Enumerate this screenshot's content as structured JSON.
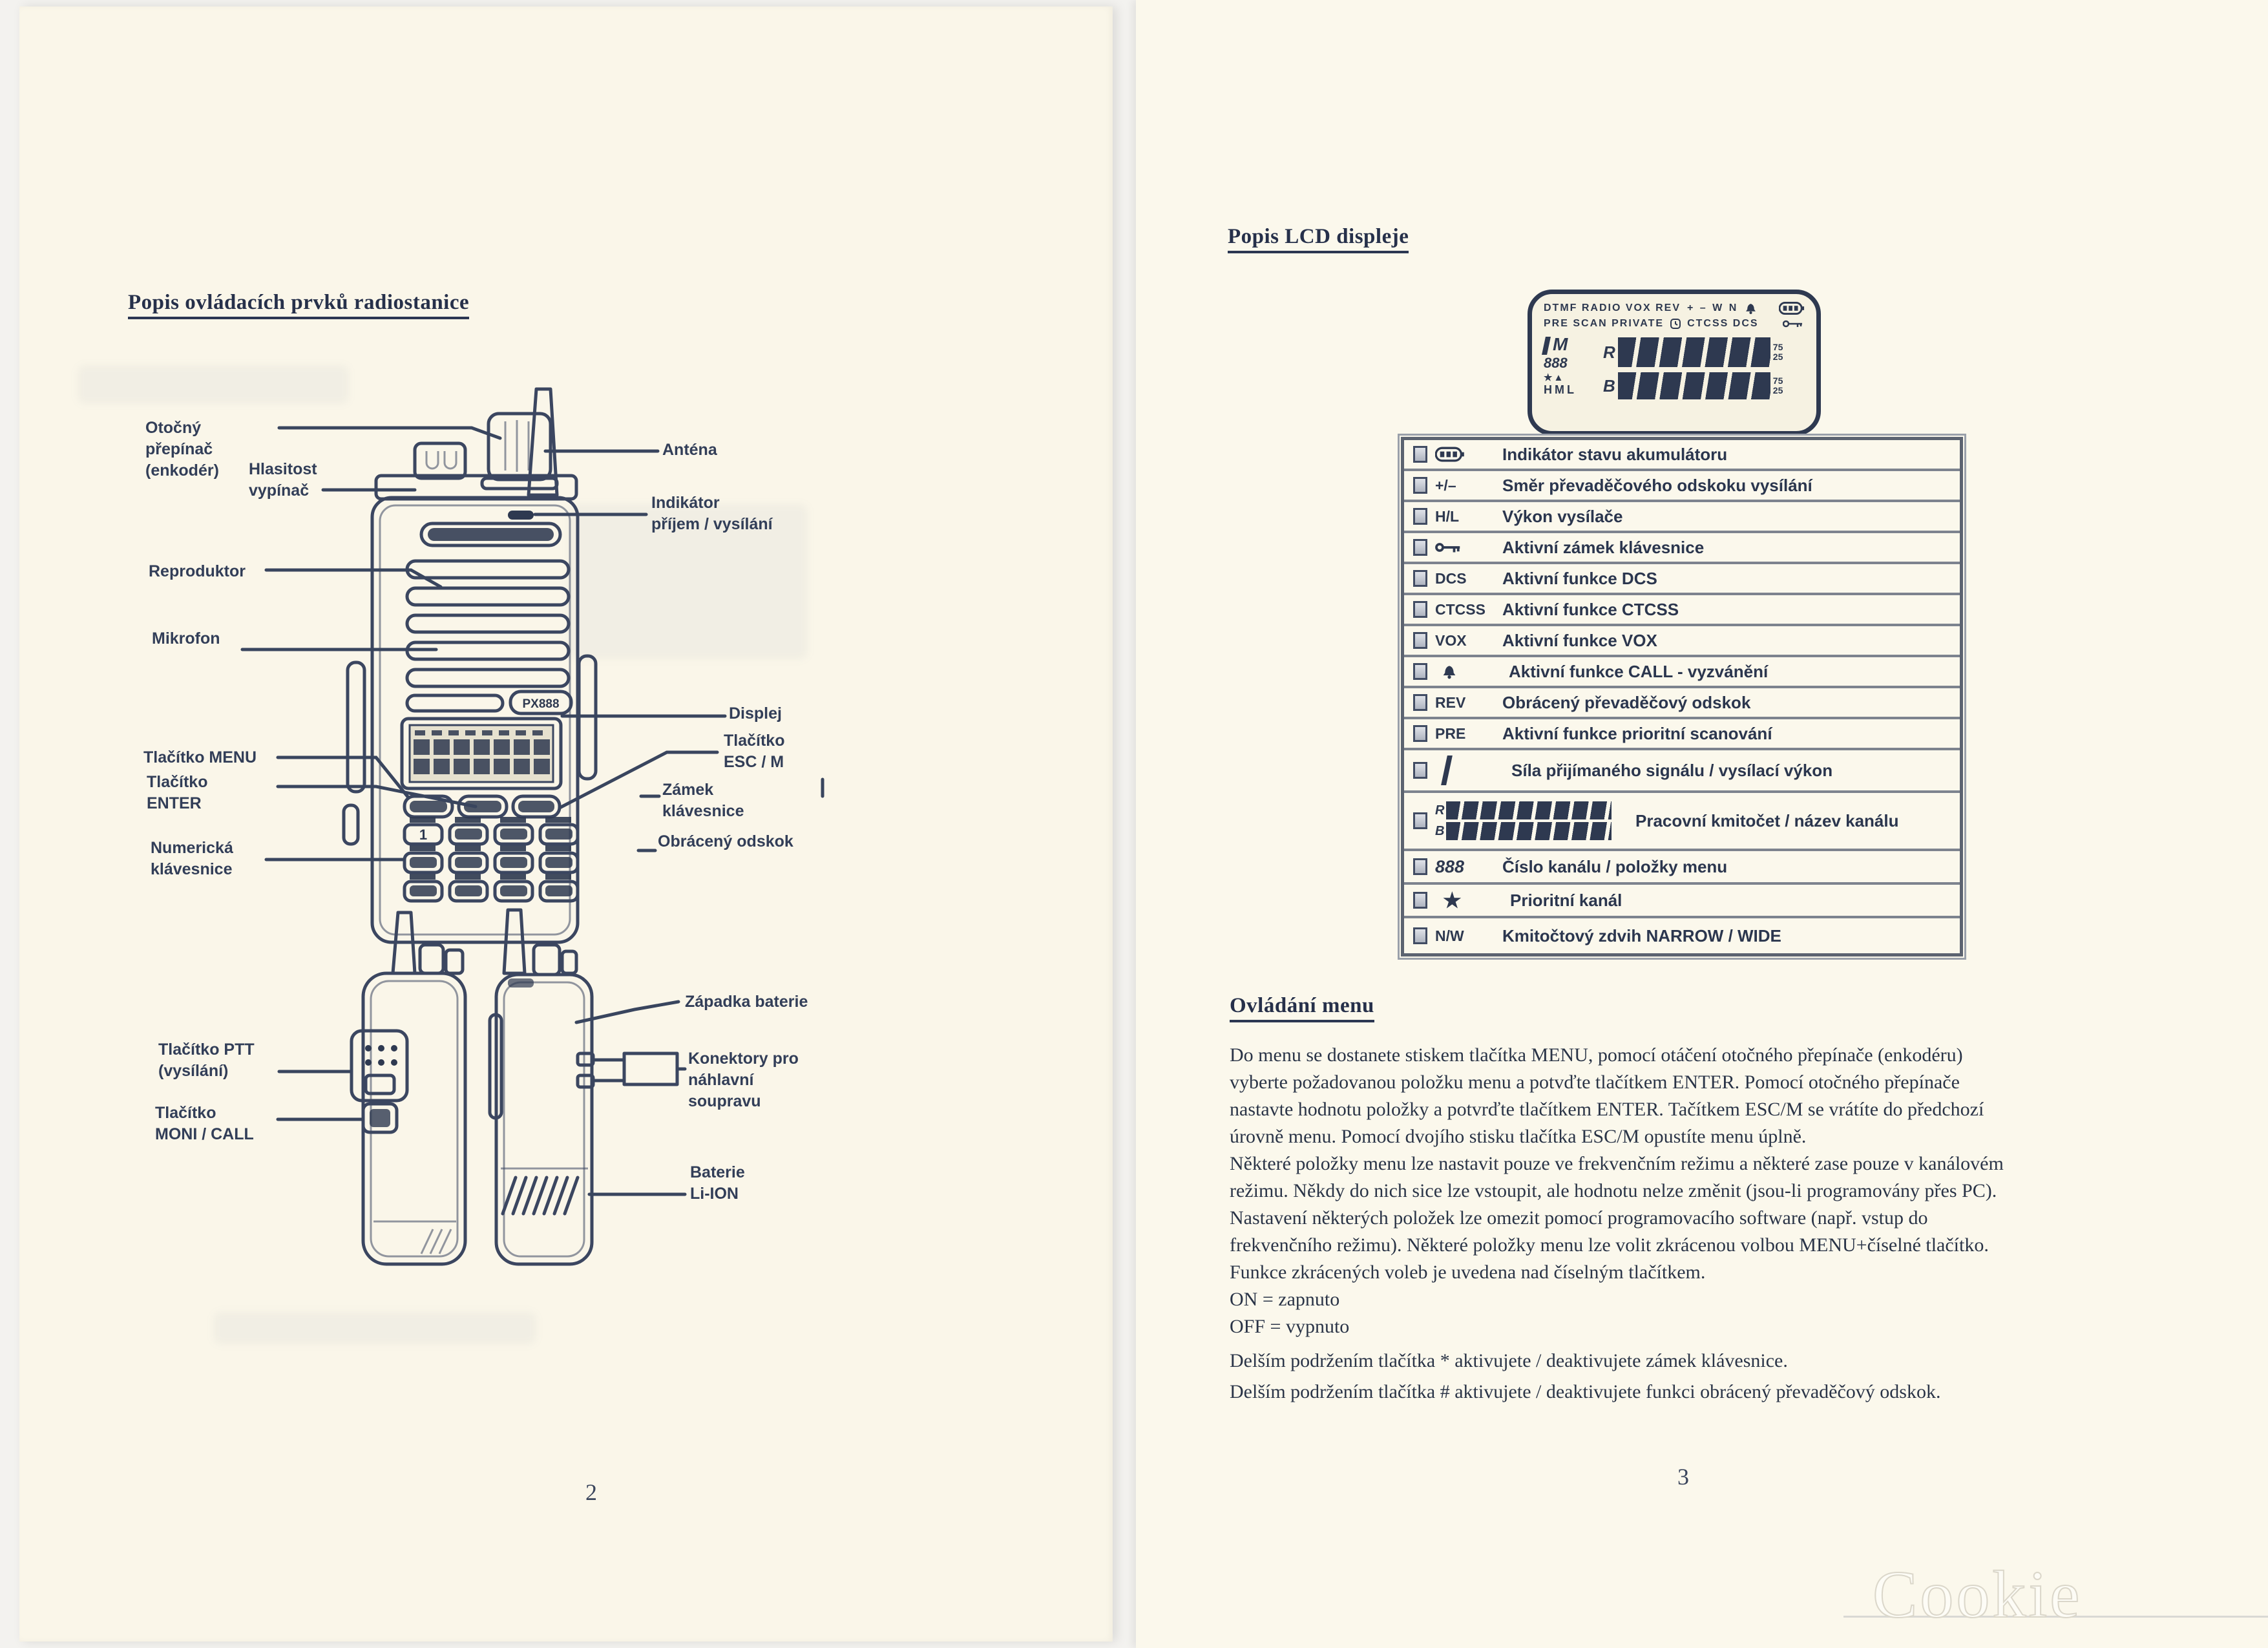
{
  "left_page": {
    "title": "Popis ovládacích prvků radiostanice",
    "page_number": "2",
    "radio": {
      "model": "PX888",
      "key1": "1"
    },
    "front_labels": {
      "rotary": "Otočný\npřepínač\n(enkodér)",
      "volume": "Hlasitost\nvypínač",
      "speaker": "Reproduktor",
      "mic": "Mikrofon",
      "menu": "Tlačítko MENU",
      "enter": "Tlačítko\nENTER",
      "numkeys": "Numerická\nklávesnice",
      "antenna": "Anténa",
      "indicator": "Indikátor\npříjem / vysílání",
      "display": "Displej",
      "esc": "Tlačítko\nESC / M",
      "keylock": "Zámek\nklávesnice",
      "reverse": "Obrácený odskok"
    },
    "side_labels": {
      "ptt": "Tlačítko PTT\n(vysílání)",
      "moni": "Tlačítko\nMONI / CALL",
      "latch": "Západka baterie",
      "connectors": "Konektory pro\nnáhlavní\nsoupravu",
      "battery": "Baterie\nLi-ION"
    }
  },
  "right_page": {
    "title": "Popis LCD displeje",
    "page_number": "3",
    "lcd": {
      "row1_left": "DTMF RADIO VOX REV",
      "row1_right": "+ – W N",
      "row2_left": "PRE SCAN PRIVATE",
      "row2_right": "CTCSS DCS",
      "big_m": "M",
      "digits": "888",
      "stars": "★▲",
      "power_levels": "HML",
      "seg_top_prefix": "R",
      "seg_bottom_prefix": "B",
      "frac_top": "75",
      "frac_bottom": "25"
    },
    "lcd_table": {
      "rows": [
        {
          "sym": "",
          "label": "Indikátor stavu akumulátoru"
        },
        {
          "sym": "+/–",
          "label": "Směr převaděčového odskoku vysílání"
        },
        {
          "sym": "H/L",
          "label": "Výkon vysílače"
        },
        {
          "sym": "",
          "label": "Aktivní zámek klávesnice"
        },
        {
          "sym": "DCS",
          "label": "Aktivní funkce DCS"
        },
        {
          "sym": "CTCSS",
          "label": "Aktivní funkce CTCSS"
        },
        {
          "sym": "VOX",
          "label": "Aktivní funkce VOX"
        },
        {
          "sym": "",
          "label": "Aktivní funkce  CALL - vyzvánění"
        },
        {
          "sym": "REV",
          "label": "Obrácený převaděčový odskok"
        },
        {
          "sym": "PRE",
          "label": "Aktivní funkce prioritní scanování"
        },
        {
          "sym": "",
          "label": "Síla přijímaného signálu / vysílací výkon"
        },
        {
          "sym": "",
          "label": "Pracovní kmitočet / název kanálu"
        },
        {
          "sym": "888",
          "label": "Číslo kanálu / položky menu"
        },
        {
          "sym": "★",
          "label": "Prioritní kanál"
        },
        {
          "sym": "N/W",
          "label": "Kmitočtový zdvih NARROW / WIDE"
        }
      ]
    },
    "menu": {
      "heading": "Ovládání menu",
      "para1": "Do menu se dostanete stiskem tlačítka MENU, pomocí otáčení otočného přepínače (enkodéru)\nvyberte požadovanou položku menu a potvďte tlačítkem ENTER. Pomocí otočného přepínače\nnastavte hodnotu položky a potvrďte tlačítkem ENTER. Tačítkem ESC/M se vrátíte do předchozí\núrovně menu. Pomocí dvojího stisku tlačítka ESC/M opustíte menu úplně.\nNěkteré položky menu lze nastavit pouze ve frekvenčním režimu a některé zase pouze v kanálovém\nrežimu. Někdy do nich sice lze vstoupit, ale hodnotu nelze změnit (jsou-li programovány přes PC).\nNastavení některých položek lze omezit pomocí programovacího software (např. vstup do\nfrekvenčního režimu). Některé položky menu lze volit zkrácenou volbou MENU+číselné tlačítko.\nFunkce zkrácených voleb je uvedena nad číselným tlačítkem.\nON = zapnuto\nOFF = vypnuto",
      "para2": "Delším podržením tlačítka * aktivujete / deaktivujete zámek klávesnice.\nDelším podržením tlačítka # aktivujete / deaktivujete funkci obrácený převaděčový odskok."
    }
  },
  "watermark": "Cookie 5.UZU"
}
